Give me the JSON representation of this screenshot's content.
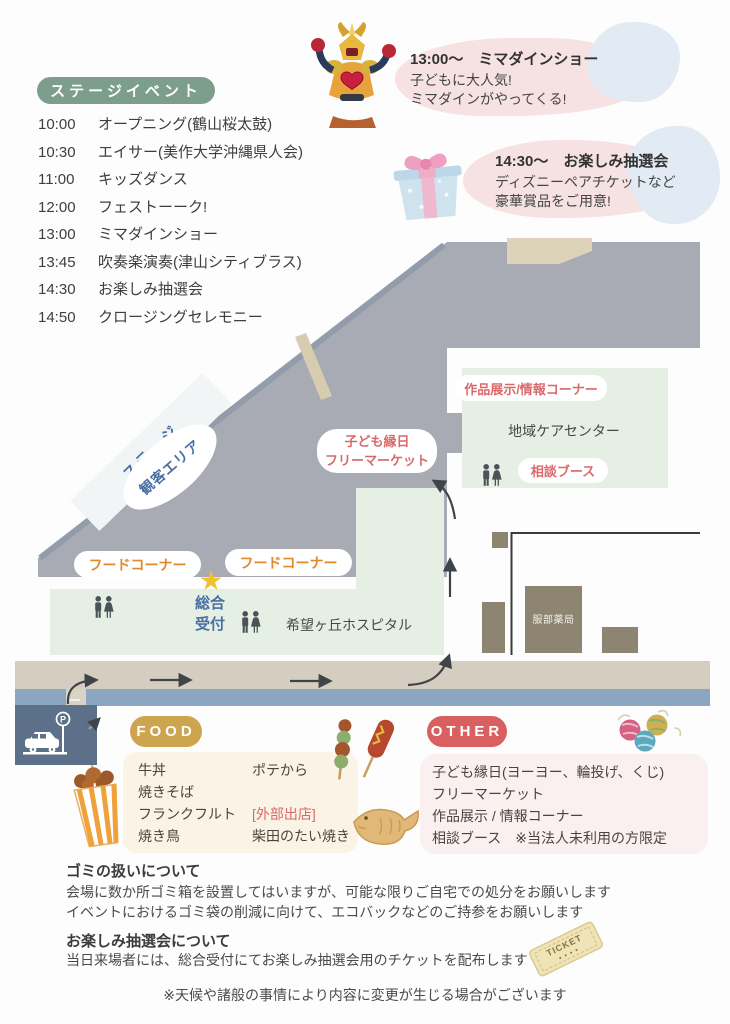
{
  "colors": {
    "badge_green": "#7d9e8c",
    "accent_red": "#d9696b",
    "accent_orange": "#e08a2e",
    "accent_blue": "#4a6fa5",
    "food_badge_gold": "#cda54e",
    "other_badge_red": "#d96060",
    "map_gray": "#a8abb3",
    "map_green": "#e5efe4",
    "road_tan": "#d5cec0",
    "road_blue": "#8ca6c2",
    "building_brown": "#8d8472",
    "star_yellow": "#f2c12e"
  },
  "schedule": {
    "badge": "ステージイベント",
    "items": [
      {
        "time": "10:00",
        "title": "オープニング(鶴山桜太鼓)"
      },
      {
        "time": "10:30",
        "title": "エイサー(美作大学沖縄県人会)"
      },
      {
        "time": "11:00",
        "title": "キッズダンス"
      },
      {
        "time": "12:00",
        "title": "フェストーーク!"
      },
      {
        "time": "13:00",
        "title": "ミマダインショー"
      },
      {
        "time": "13:45",
        "title": "吹奏楽演奏(津山シティブラス)"
      },
      {
        "time": "14:30",
        "title": "お楽しみ抽選会"
      },
      {
        "time": "14:50",
        "title": "クロージングセレモニー"
      }
    ]
  },
  "announcements": [
    {
      "title": "13:00〜　ミマダインショー",
      "line1": "子どもに大人気!",
      "line2": "ミマダインがやってくる!"
    },
    {
      "title": "14:30〜　お楽しみ抽選会",
      "line1": "ディズニーペアチケットなど",
      "line2": "豪華賞品をご用意!"
    }
  ],
  "map": {
    "stage": "ステージ",
    "audience_area": "観客エリア",
    "kids_line1": "子ども縁日",
    "kids_line2": "フリーマーケット",
    "exhibit_pill": "作品展示/情報コーナー",
    "care_center": "地域ケアセンター",
    "consult_pill": "相談ブース",
    "food_corner": "フードコーナー",
    "reception": "総合受付",
    "hospital": "希望ヶ丘ホスピタル",
    "pharmacy": "服部薬局",
    "parking_letter": "P"
  },
  "food": {
    "badge": "FOOD",
    "col1": [
      "牛丼",
      "焼きそば",
      "フランクフルト",
      "焼き鳥"
    ],
    "col2_item": "ポテから",
    "external_tag": "[外部出店]",
    "external_item": "柴田のたい焼き"
  },
  "other": {
    "badge": "OTHER",
    "items": [
      "子ども縁日(ヨーヨー、輪投げ、くじ)",
      "フリーマーケット",
      "作品展示 / 情報コーナー",
      "相談ブース　※当法人未利用の方限定"
    ]
  },
  "notes": {
    "trash_title": "ゴミの扱いについて",
    "trash_line1": "会場に数か所ゴミ箱を設置してはいますが、可能な限りご自宅での処分をお願いします",
    "trash_line2": "イベントにおけるゴミ袋の削減に向けて、エコバックなどのご持参をお願いします",
    "lottery_title": "お楽しみ抽選会について",
    "lottery_line": "当日来場者には、総合受付にてお楽しみ抽選会用のチケットを配布します",
    "disclaimer": "※天候や諸般の事情により内容に変更が生じる場合がございます"
  },
  "ticket_label": "TICKET"
}
